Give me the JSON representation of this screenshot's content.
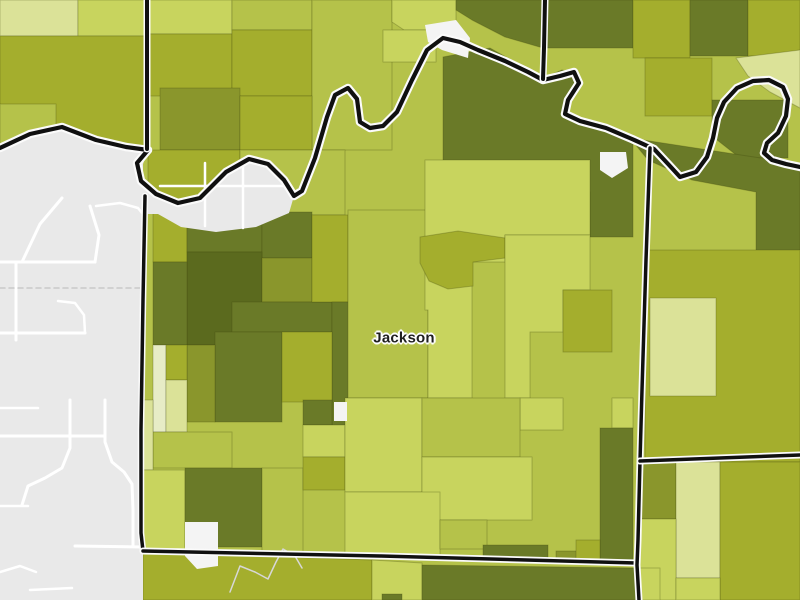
{
  "map": {
    "label": "Jackson",
    "kind": "county-choropleth",
    "palette": {
      "g0": "#e7ecc6",
      "g1": "#dbe298",
      "g2": "#c8d45e",
      "g3": "#b5c24a",
      "g4": "#a4ae2d",
      "g5": "#8a962c",
      "g6": "#6a7a28",
      "g7": "#5b6a1e",
      "basemap": "#e9e9e9",
      "water": "#f4f4f4",
      "road": "#ffffff",
      "stream": "#d7d7d7",
      "dash": "#c9c9c9",
      "boundary": "#101010",
      "casing": "#fbfbfb",
      "tract_line": "rgba(60,68,10,0.28)",
      "label_color": "#1f1f1f"
    },
    "base_fill": "g3",
    "regions": [
      {
        "fill": "g1",
        "points": "0,0 78,0 78,36 0,36"
      },
      {
        "fill": "g2",
        "points": "78,0 148,0 148,36 78,36"
      },
      {
        "fill": "g4",
        "points": "0,36 148,36 148,150 125,147 96,140 62,127 30,134 0,148"
      },
      {
        "fill": "g3",
        "points": "0,104 56,104 56,140 30,134 0,146"
      },
      {
        "fill": "g2",
        "points": "148,0 232,0 232,34 148,34"
      },
      {
        "fill": "g4",
        "points": "148,34 232,34 232,96 148,96"
      },
      {
        "fill": "g3",
        "points": "232,0 312,0 312,30 232,30"
      },
      {
        "fill": "g4",
        "points": "232,30 312,30 312,96 232,96"
      },
      {
        "fill": "g3",
        "points": "312,0 392,0 392,150 312,150"
      },
      {
        "fill": "g2",
        "points": "392,0 456,0 456,30 404,30 392,22"
      },
      {
        "fill": "g2",
        "points": "383,30 436,30 436,62 383,62"
      },
      {
        "fill": "g6",
        "points": "456,0 633,0 633,48 543,48 505,37 472,20 456,10"
      },
      {
        "fill": "g4",
        "points": "633,0 690,0 690,58 633,58"
      },
      {
        "fill": "g6",
        "points": "690,0 748,0 748,56 690,56"
      },
      {
        "fill": "g4",
        "points": "748,0 800,0 800,56 748,56"
      },
      {
        "fill": "g5",
        "points": "160,88 240,88 240,150 160,150"
      },
      {
        "fill": "g4",
        "points": "240,96 312,96 312,150 240,150"
      },
      {
        "fill": "g1",
        "points": "736,58 800,50 800,108 770,92 748,76"
      },
      {
        "fill": "g4",
        "points": "645,58 712,58 712,116 645,116"
      },
      {
        "fill": "g6",
        "points": "712,100 788,100 788,158 740,158 712,136"
      },
      {
        "fill": "g6",
        "points": "443,57 490,48 543,78 562,70 578,74 566,100 566,116 602,127 633,140 633,237 590,237 590,192 443,192"
      },
      {
        "fill": "g6",
        "points": "630,138 800,164 800,252 756,252 756,192 692,180 648,160"
      },
      {
        "fill": "g4",
        "points": "148,150 240,150 240,206 148,200"
      },
      {
        "fill": "g3",
        "points": "240,150 345,150 345,215 240,215"
      },
      {
        "fill": "g4",
        "points": "153,200 187,204 187,262 153,262"
      },
      {
        "fill": "g6",
        "points": "187,202 262,208 262,252 187,252"
      },
      {
        "fill": "g6",
        "points": "262,212 312,212 312,258 262,258"
      },
      {
        "fill": "g7",
        "points": "187,252 262,252 262,345 187,345"
      },
      {
        "fill": "g6",
        "points": "153,262 187,262 187,345 153,345"
      },
      {
        "fill": "g5",
        "points": "262,258 312,258 312,302 262,302"
      },
      {
        "fill": "g6",
        "points": "232,302 332,302 332,332 232,332"
      },
      {
        "fill": "g4",
        "points": "312,215 348,215 348,302 312,302"
      },
      {
        "fill": "g6",
        "points": "332,302 356,302 356,398 348,432 332,432"
      },
      {
        "fill": "g6",
        "points": "215,332 282,332 282,422 215,422"
      },
      {
        "fill": "g4",
        "points": "282,332 332,332 332,402 282,402"
      },
      {
        "fill": "g5",
        "points": "187,345 215,345 215,422 187,422"
      },
      {
        "fill": "g0",
        "points": "153,345 166,345 166,432 153,432"
      },
      {
        "fill": "g4",
        "points": "166,345 187,345 187,380 166,380"
      },
      {
        "fill": "g1",
        "points": "166,380 187,380 187,432 166,432"
      },
      {
        "fill": "g3",
        "points": "153,432 232,432 232,468 153,468"
      },
      {
        "fill": "g1",
        "points": "143,400 153,400 153,470 143,470"
      },
      {
        "fill": "g2",
        "points": "143,470 185,470 185,552 143,552"
      },
      {
        "fill": "g6",
        "points": "185,468 262,468 262,547 185,547"
      },
      {
        "fill": "g3",
        "points": "262,468 303,468 303,556 262,556"
      },
      {
        "fill": "g6",
        "points": "303,400 332,400 332,425 303,425"
      },
      {
        "fill": "g2",
        "points": "303,425 345,425 345,457 303,457"
      },
      {
        "fill": "g4",
        "points": "303,457 345,457 345,490 303,490"
      },
      {
        "fill": "g3",
        "points": "348,210 428,210 428,398 348,398"
      },
      {
        "fill": "g2",
        "points": "425,160 590,160 590,235 505,235 505,262 472,262 472,398 428,398 428,310 425,310"
      },
      {
        "fill": "g4",
        "points": "420,237 458,231 505,238 505,258 473,262 473,286 448,289 429,281 420,263"
      },
      {
        "fill": "g2",
        "points": "505,235 590,235 590,290 563,290 563,332 530,332 530,398 505,398"
      },
      {
        "fill": "g4",
        "points": "563,290 612,290 612,352 563,352"
      },
      {
        "fill": "g2",
        "points": "612,398 633,398 633,428 612,428"
      },
      {
        "fill": "g6",
        "points": "600,428 633,428 633,564 600,564"
      },
      {
        "fill": "g2",
        "points": "520,398 563,398 563,430 520,430"
      },
      {
        "fill": "g2",
        "points": "345,398 422,398 422,492 345,492"
      },
      {
        "fill": "g3",
        "points": "422,398 520,398 520,457 422,457"
      },
      {
        "fill": "g2",
        "points": "422,457 532,457 532,520 422,520"
      },
      {
        "fill": "g2",
        "points": "345,492 440,492 440,557 345,557"
      },
      {
        "fill": "g3",
        "points": "440,520 487,520 487,549 440,549"
      },
      {
        "fill": "g6",
        "points": "483,545 548,545 548,561 483,561"
      },
      {
        "fill": "g5",
        "points": "556,551 588,551 588,562 556,562"
      },
      {
        "fill": "g4",
        "points": "576,540 600,540 600,562 576,562"
      },
      {
        "fill": "g4",
        "points": "645,250 800,250 800,462 645,462"
      },
      {
        "fill": "g1",
        "points": "650,298 716,298 716,396 650,396"
      },
      {
        "fill": "g5",
        "points": "638,462 676,462 676,519 638,519"
      },
      {
        "fill": "g1",
        "points": "676,462 720,462 720,578 676,578"
      },
      {
        "fill": "g4",
        "points": "720,462 800,462 800,600 720,600"
      },
      {
        "fill": "g2",
        "points": "638,519 676,519 676,600 638,600"
      },
      {
        "fill": "g2",
        "points": "676,578 720,578 720,600 676,600"
      },
      {
        "fill": "g4",
        "points": "143,552 372,560 372,600 143,600"
      },
      {
        "fill": "g2",
        "points": "372,560 422,563 422,600 372,600"
      },
      {
        "fill": "g6",
        "points": "422,565 637,568 637,600 422,600"
      },
      {
        "fill": "g2",
        "points": "637,568 660,568 660,600 637,600"
      },
      {
        "fill": "g6",
        "points": "382,594 402,594 402,600 382,600"
      }
    ],
    "gray_areas": [
      {
        "points": "0,148 30,134 62,127 96,140 126,147 148,150 143,164 143,600 0,600"
      },
      {
        "points": "143,164 141,182 156,194 178,203 200,198 226,172 249,159 268,164 284,180 294,196 289,213 256,227 216,232 181,227 158,214 143,214"
      }
    ],
    "water_patches": [
      {
        "points": "425,25 456,20 470,38 468,58 442,50 428,42"
      },
      {
        "points": "600,152 626,152 628,168 612,178 600,170"
      },
      {
        "points": "334,402 347,402 347,421 334,421"
      },
      {
        "points": "185,522 218,522 218,566 197,569 185,556"
      }
    ],
    "roads": [
      {
        "w": 3,
        "points": "0,262 95,262"
      },
      {
        "w": 3,
        "points": "16,262 16,340"
      },
      {
        "w": 3,
        "points": "0,333 85,333"
      },
      {
        "w": 2.5,
        "points": "58,301 75,303 84,315 85,333"
      },
      {
        "w": 3,
        "points": "95,262 99,235 90,206"
      },
      {
        "w": 3,
        "points": "62,198 40,224 22,262"
      },
      {
        "w": 3,
        "points": "0,436 105,436"
      },
      {
        "w": 3,
        "points": "70,400 70,448 62,468 45,478 28,486 22,505"
      },
      {
        "w": 3,
        "points": "105,400 105,442 112,462 124,472 132,484 133,510 133,546"
      },
      {
        "w": 3,
        "points": "75,546 143,547"
      },
      {
        "w": 2.5,
        "points": "0,506 28,506"
      },
      {
        "w": 2.5,
        "points": "0,408 38,408"
      },
      {
        "w": 2.5,
        "points": "160,186 288,186"
      },
      {
        "w": 2.5,
        "points": "205,163 205,226"
      },
      {
        "w": 2.5,
        "points": "243,161 243,228"
      },
      {
        "w": 2.5,
        "points": "0,572 20,566 36,572"
      },
      {
        "w": 2.5,
        "points": "30,590 72,588"
      },
      {
        "w": 2.5,
        "points": "96,206 120,203 138,208 146,218"
      }
    ],
    "streams": [
      {
        "points": "230,592 240,566 255,572 268,579 276,562 283,549 295,556 302,568"
      }
    ],
    "dashed_lines": [
      {
        "points": "0,288 140,288"
      }
    ],
    "boundaries": [
      {
        "name": "river-county-line",
        "core": 4.2,
        "casing": 8.5,
        "points": "0,148 30,134 62,127 96,140 126,147 148,150 137,163 141,181 156,194 178,203 200,198 226,172 249,159 268,164 284,180 294,196 302,191 315,158 327,117 335,95 348,88 357,99 360,122 370,128 383,126 397,112 412,80 427,50 443,38 460,42 478,50 505,61 528,72 543,80 560,76 574,72 579,83 568,100 565,114 580,121 606,128 632,139 654,149 669,165 680,177 696,172 707,157 713,138 717,118 724,102 737,88 753,81 769,80 783,87 788,99 786,116 778,133 767,143 764,153 772,160 786,164 800,167"
      },
      {
        "name": "north-vertical-line",
        "core": 4,
        "casing": 7,
        "points": "147,0 147,149"
      },
      {
        "name": "north-east-vertical-line",
        "core": 4,
        "casing": 7,
        "points": "545,0 544,48 543,79"
      },
      {
        "name": "west-county-line",
        "core": 3.5,
        "casing": 6.5,
        "points": "145,196 143,300 141,430 141,533 143,551"
      },
      {
        "name": "south-county-line",
        "core": 3.5,
        "casing": 7,
        "points": "143,551 380,556 637,563"
      },
      {
        "name": "east-county-line",
        "core": 3.5,
        "casing": 7,
        "points": "650,148 646,260 642,390 640,461 638,540 637,565 639,600"
      },
      {
        "name": "east-horizontal-county-line",
        "core": 3.5,
        "casing": 7,
        "points": "640,461 800,455"
      }
    ],
    "label_pos": {
      "x": 404,
      "y": 338
    }
  }
}
